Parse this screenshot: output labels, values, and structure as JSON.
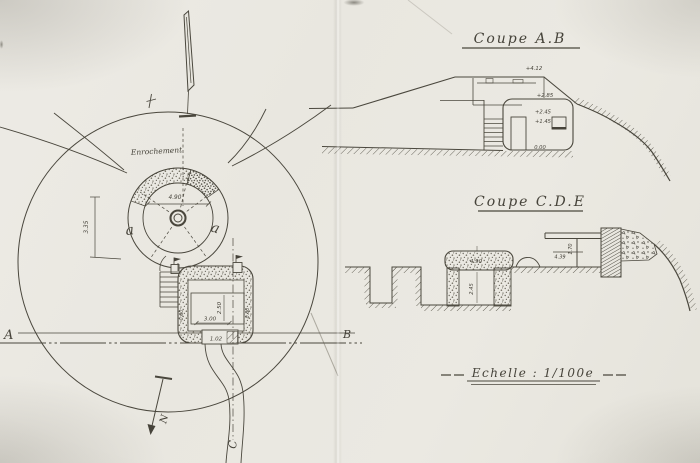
{
  "plan": {
    "enrochement_label": "Enrochement",
    "gun_pit_letter_left": "a",
    "gun_pit_letter_right": "a",
    "dims": {
      "pit_diameter": "4.90",
      "glacis_radius": "3.35",
      "room_width": "3.00",
      "room_depth": "2.50",
      "entry_width": "1.02",
      "wall_left": "0.80",
      "wall_right": "0.80"
    },
    "section_points": {
      "a": "A",
      "b": "B",
      "c": "C"
    },
    "north_label": "N"
  },
  "coupe_ab": {
    "title": "Coupe A.B",
    "elevations": {
      "crest": "+4.12",
      "platform": "+2.85",
      "door": "+2.45",
      "window": "+1.45",
      "floor": "0.00"
    }
  },
  "coupe_cde": {
    "title": "Coupe C.D.E",
    "dims": {
      "slab_width": "4.90",
      "chamber_height": "2.45",
      "beam_length": "4.39",
      "post_height": "1.70"
    }
  },
  "scale": {
    "label": "Echelle : 1/100e"
  }
}
